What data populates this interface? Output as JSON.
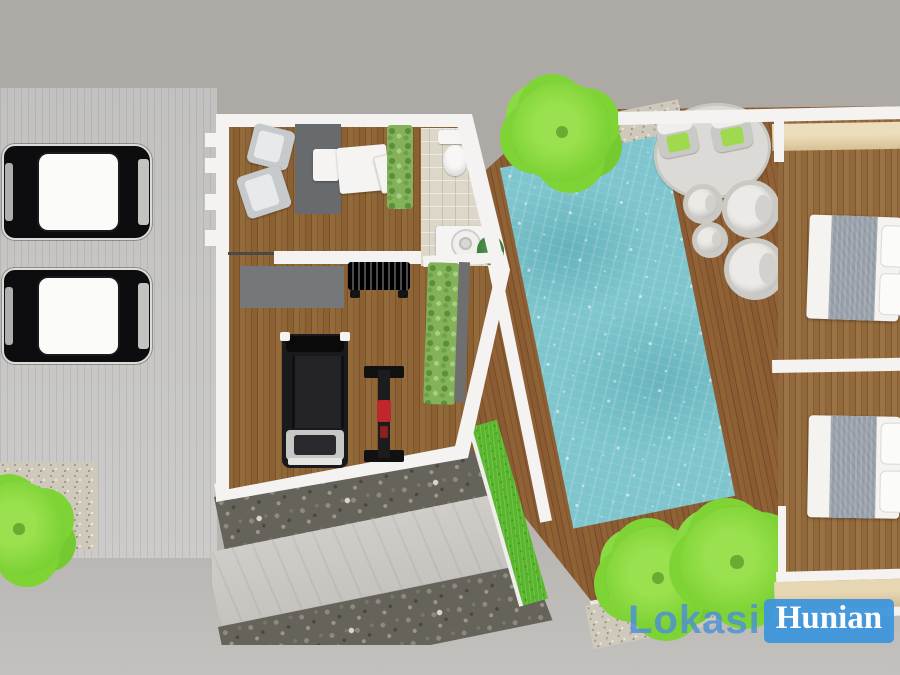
{
  "watermark": {
    "text_plain": "Lokasi",
    "text_boxed": "Hunian"
  },
  "palette": {
    "background": "#aeaba6",
    "driveway": "#c6c5c3",
    "wall_white": "#f4f3f1",
    "wood_floor": "#8a6134",
    "deck_wood": "#8a5c33",
    "bedroom_wood": "#92693c",
    "pool_water": "#7ec5cd",
    "pool_highlight": "#cdeef2",
    "hedge_green": "#83b258",
    "palm_green": "#7ed335",
    "grass_green": "#59b62c",
    "gravel": "#cfc9bc",
    "pebble_dark": "#66635b",
    "concrete_path": "#ccc9c5",
    "tile_beige": "#dcd7c9",
    "wardrobe_beige": "#d9c49e",
    "rug_dark": "#686b6d",
    "rug_light": "#dbdad6",
    "car_body": "#0d0d0f",
    "car_roof": "#fbfbf9",
    "bed_blanket": "#99a1ab",
    "equipment_black": "#18181a",
    "accent_red": "#c0272d",
    "wm_plain": "#4b90d6",
    "wm_box_bg": "#3e96dc",
    "wm_box_text": "#ffffff"
  },
  "objects": [
    "two-cars-parked-on-striped-driveway",
    "gravel-bed-with-shrub-at-driveway-end",
    "home-office-with-two-armchairs-rug-desk-and-side-table",
    "indoor-planter-hedges",
    "bathroom-with-toilet-on-beige-tile",
    "laundry-counter-with-top-load-washer-and-plant",
    "gym-with-treadmill-dumbbell-rack-and-weight-machine",
    "rotated-swimming-pool-with-water-texture",
    "hardwood-pool-deck",
    "oval-outdoor-rug-with-two-lounge-chairs-green-cushions",
    "four-round-pod-seats",
    "two-bedrooms-with-double-beds-gray-blankets-white-pillows",
    "beige-wardrobe-bands-top-and-bottom-of-bedrooms",
    "diagonal-concrete-walkway-between-pebble-beds",
    "grass-strip-and-palm-trees"
  ]
}
